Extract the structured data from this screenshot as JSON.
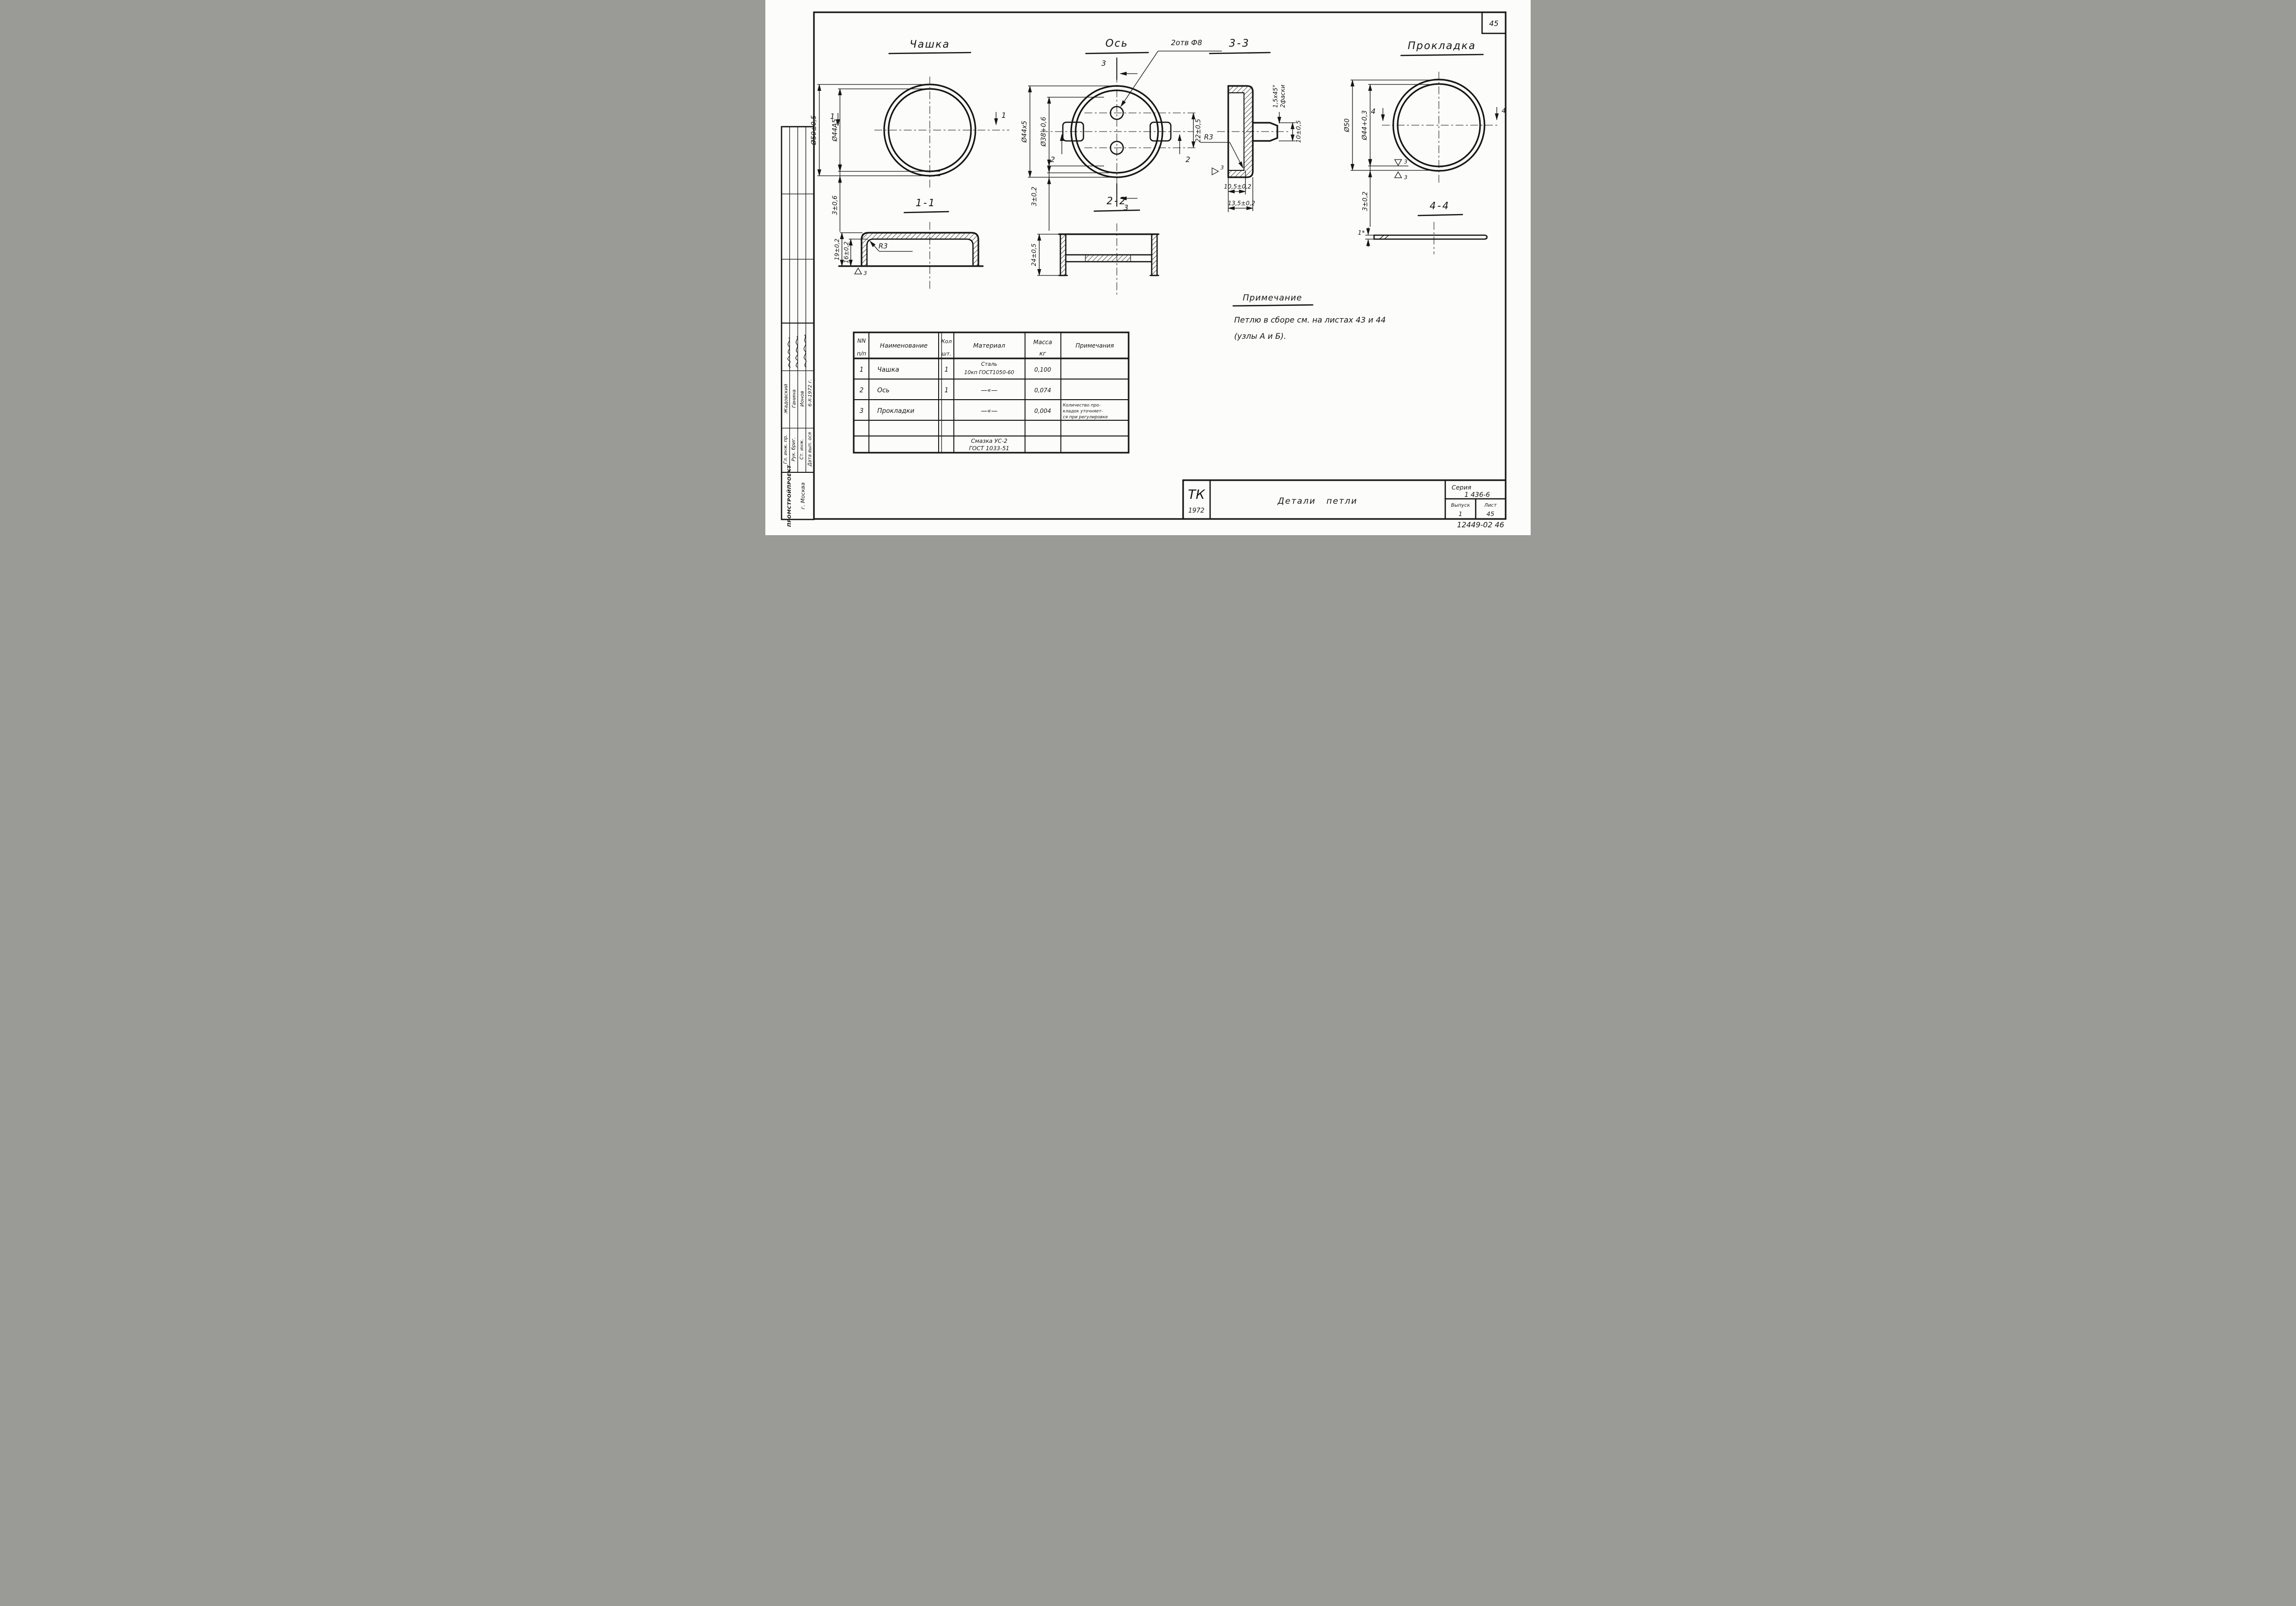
{
  "sheet": {
    "corner_number": "45",
    "doc_number": "12449-02  46"
  },
  "views": {
    "chashka": {
      "title": "Чашка",
      "dim_outer": "Ø50±0,5",
      "dim_inner": "Ø44А5",
      "dim_flange": "3±0,6",
      "cut_label": "1"
    },
    "os": {
      "title": "Ось",
      "callout": "2отв Ф8",
      "dim_outer": "Ø44х5",
      "dim_inner": "Ø38+0,6",
      "dim_holes": "22±0,5",
      "dim_flange": "3±0,2",
      "cut2": "2",
      "cut3": "3"
    },
    "s33": {
      "title": "3-3",
      "chamfer1": "1,5х45°",
      "chamfer2": "2фаски",
      "dim_pin": "10±0,5",
      "radius": "R3",
      "finish": "3",
      "dim_depth": "10,5±0,2",
      "dim_width": "13,5±0,2"
    },
    "prokladka": {
      "title": "Прокладка",
      "dim_outer": "Ø50",
      "dim_inner": "Ø44+0,3",
      "dim_flange": "3±0,2",
      "finish": "3",
      "cut_label": "4"
    },
    "s11": {
      "title": "1-1",
      "radius": "R3",
      "dim_outer": "19±0,2",
      "dim_inner": "16±0,2",
      "finish": "3"
    },
    "s22": {
      "title": "2-2",
      "dim_height": "24±0,5"
    },
    "s44": {
      "title": "4-4",
      "dim_thickness": "1*"
    }
  },
  "note": {
    "title": "Примечание",
    "line1": "Петлю  в сборе  см. на листах  43 и 44",
    "line2": "(узлы  А и Б)."
  },
  "table": {
    "header": {
      "c0a": "NN",
      "c0b": "п/п",
      "c1": "Наименование",
      "c2a": "Кол",
      "c2b": "шт.",
      "c3": "Материал",
      "c4a": "Масса",
      "c4b": "кг",
      "c5": "Примечания"
    },
    "rows": [
      {
        "num": "1",
        "name": "Чашка",
        "qty": "1",
        "mat1": "Сталь",
        "mat2": "10кп ГОСТ1050-60",
        "mass": "0,100"
      },
      {
        "num": "2",
        "name": "Ось",
        "qty": "1",
        "mat1": "—«—",
        "mass": "0,074"
      },
      {
        "num": "3",
        "name": "Прокладки",
        "qty": "",
        "mat1": "—«—",
        "mass": "0,004",
        "note1": "Количество про-",
        "note2": "кладок уточняет-",
        "note3": "ся при регулировке"
      },
      {
        "mat1": "Смазка УС-2",
        "mat2": "ГОСТ 1033-51"
      }
    ]
  },
  "title_block": {
    "org_code": "ТК",
    "year": "1972",
    "title": "Детали  петли",
    "series_label": "Серия",
    "series_value": "1 436-6",
    "issue_label": "Выпуск",
    "issue_value": "1",
    "sheet_label": "Лист",
    "sheet_value": "45"
  },
  "sidebar": {
    "org": "ПРОМСТРОЙПРОЕКТ",
    "city": "г. Москва",
    "rows": [
      {
        "role": "Гл. инж. пр.",
        "name": "Жадовский"
      },
      {
        "role": "Рук. бриг.",
        "name": "Ганина"
      },
      {
        "role": "Ст. инж.",
        "name": "Ионов"
      },
      {
        "role": "Дата вып. ося",
        "name": "6-X-1972 г."
      }
    ]
  }
}
